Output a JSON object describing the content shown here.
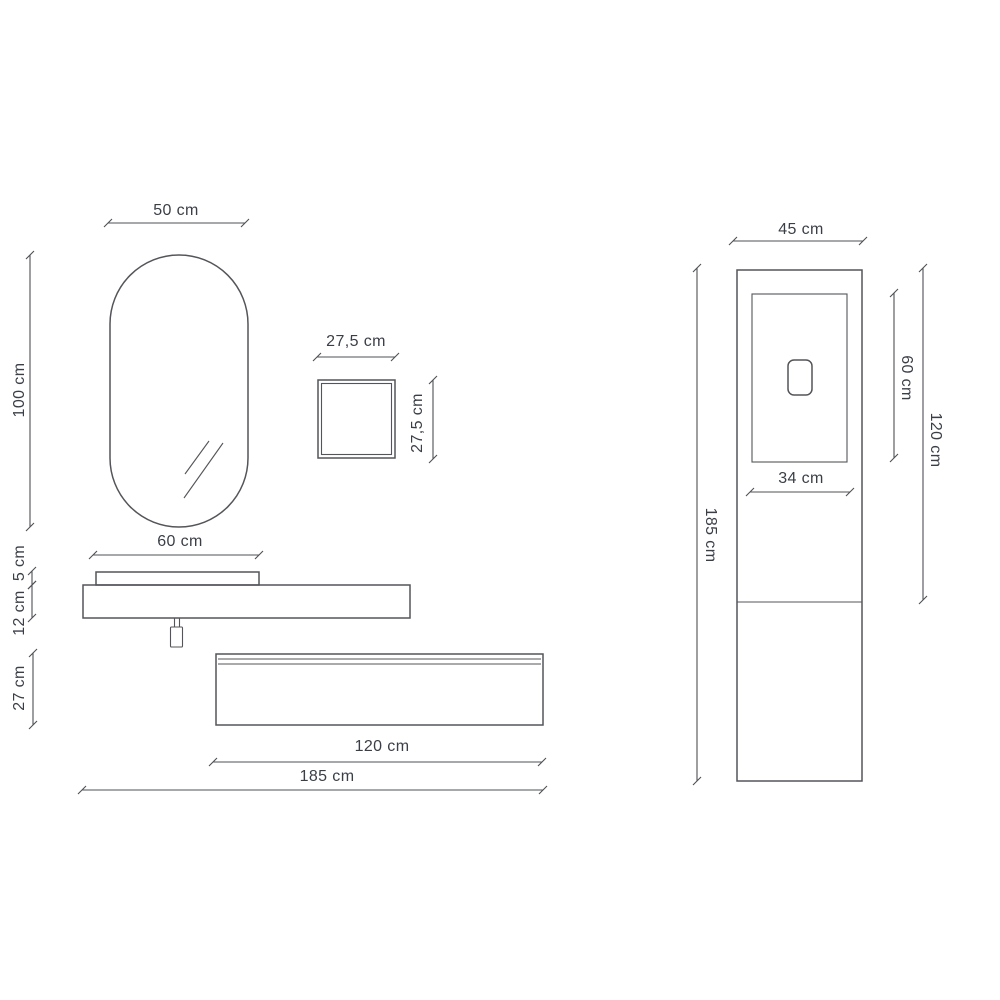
{
  "drawing": {
    "type": "bathroom-furniture-dimension-diagram",
    "colors": {
      "background": "#ffffff",
      "line": "#54555a",
      "text": "#3a3f47"
    }
  },
  "dimensions": {
    "mirror": {
      "width": "50 cm",
      "height": "100 cm"
    },
    "wall_box": {
      "width": "27,5 cm",
      "height": "27,5 cm"
    },
    "washbasin": {
      "width": "60 cm",
      "height": "5 cm"
    },
    "countertop": {
      "thickness": "12 cm",
      "total_width": "185 cm"
    },
    "drawer_unit": {
      "height": "27 cm",
      "width": "120 cm"
    },
    "column": {
      "width": "45 cm",
      "height": "185 cm",
      "upper_section_height": "120 cm",
      "door": {
        "width": "34 cm",
        "height": "60 cm"
      }
    }
  }
}
